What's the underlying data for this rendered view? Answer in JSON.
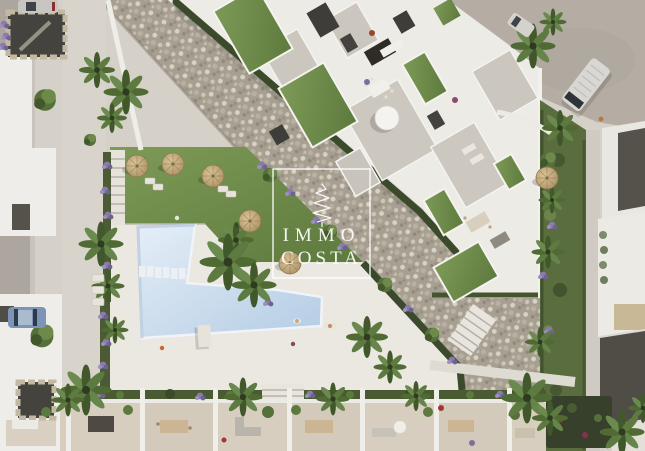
{
  "watermark": {
    "line1": "IMMO",
    "line2": "COSTA",
    "icon": "cypress-spiral-tree-icon",
    "color": "#ffffff",
    "frame": "thin white rectangle"
  },
  "palette": {
    "pavement": "#d5d1c8",
    "pool_water": "#c8daed",
    "pool_deck": "#eae8e1",
    "lawn_green": "#6f8c4a",
    "gravel_riprap": "#a69f92",
    "hedge_dark": "#3b4a2c",
    "road": "#b5ada3",
    "building_white": "#ecebe6",
    "dark_roof": "#514e48",
    "terrace_floor": "#d7cec0",
    "straw_parasol": "#c4a87b",
    "purple_flowers": "#8a7bad",
    "blue_car": "#7c95b7",
    "white_van": "#d8d7d3"
  },
  "scene": {
    "type": "aerial-architectural-render",
    "elements": [
      "swimming-pool",
      "pool-deck",
      "stepping-stones",
      "sun-loungers",
      "straw-parasols",
      "lawn",
      "palm-trees",
      "stone-riprap-slope",
      "apartment-rooftop-terraces",
      "townhouse-terrace-row",
      "flower-beds",
      "street-with-parked-cars",
      "white-van",
      "garden-stairs",
      "people"
    ]
  }
}
